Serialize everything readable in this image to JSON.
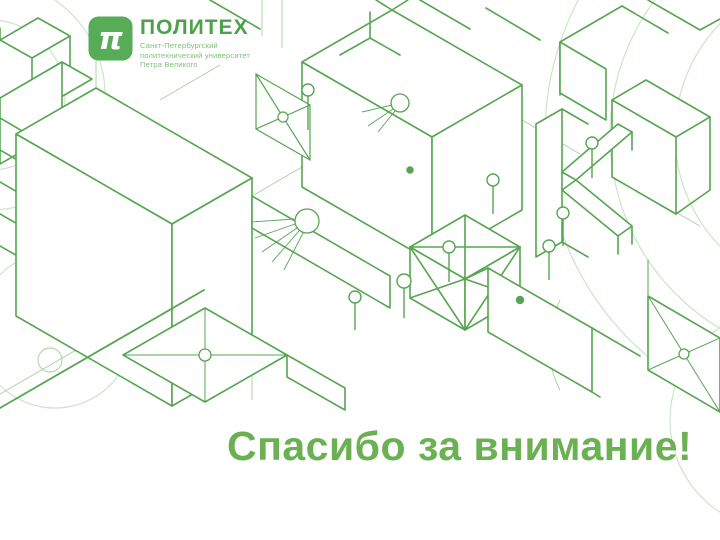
{
  "slide": {
    "thank_you_text": "Спасибо за внимание!"
  },
  "logo": {
    "pi_glyph": "π",
    "title": "ПОЛИТЕХ",
    "subtitle_lines": [
      "Санкт-Петербургский",
      "политехнический университет",
      "Петра Великого"
    ]
  },
  "colors": {
    "pattern_line_green": "#57a551",
    "pattern_light_green": "#a5d19f",
    "pattern_faint_green": "#cbe5c6",
    "logo_icon_green": "#57ac57",
    "logo_title_green": "#4ca14c",
    "logo_subtitle_green": "#7fbf7c",
    "thank_you_green": "#6bb153",
    "background": "#ffffff"
  },
  "background_pattern": {
    "style_name": "isometric-green-lineart"
  }
}
